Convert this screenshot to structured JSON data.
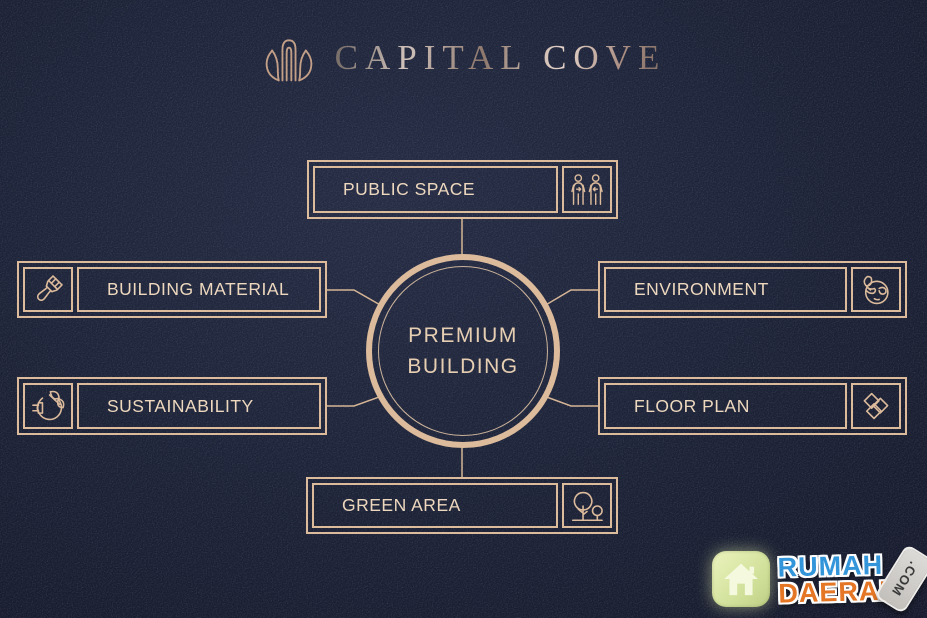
{
  "colors": {
    "background": "#1d2338",
    "line": "#dcba99",
    "label_text": "#eed8bd",
    "logo_metallic": "#cfc0b8",
    "watermark_blue": "#2e93d9",
    "watermark_orange": "#e5731f",
    "watermark_tile_green": "#cdde93"
  },
  "logo": {
    "title": "CAPITAL COVE",
    "mark": "tulip-building-icon"
  },
  "center": {
    "line1": "PREMIUM",
    "line2": "BUILDING"
  },
  "nodes": [
    {
      "label": "PUBLIC SPACE",
      "icon": "people-distance-icon",
      "position": "top",
      "icon_side": "right"
    },
    {
      "label": "BUILDING MATERIAL",
      "icon": "paintbrush-icon",
      "position": "left-top",
      "icon_side": "left"
    },
    {
      "label": "ENVIRONMENT",
      "icon": "globe-leaf-icon",
      "position": "right-top",
      "icon_side": "right"
    },
    {
      "label": "SUSTAINABILITY",
      "icon": "eco-plug-icon",
      "position": "left-bottom",
      "icon_side": "left"
    },
    {
      "label": "FLOOR PLAN",
      "icon": "floor-plan-icon",
      "position": "right-bottom",
      "icon_side": "right"
    },
    {
      "label": "GREEN AREA",
      "icon": "trees-icon",
      "position": "bottom",
      "icon_side": "right"
    }
  ],
  "watermark": {
    "site_top": "RUMAH",
    "site_bottom": "DAERAH",
    "tld": ".COM",
    "icon": "house-icon"
  }
}
